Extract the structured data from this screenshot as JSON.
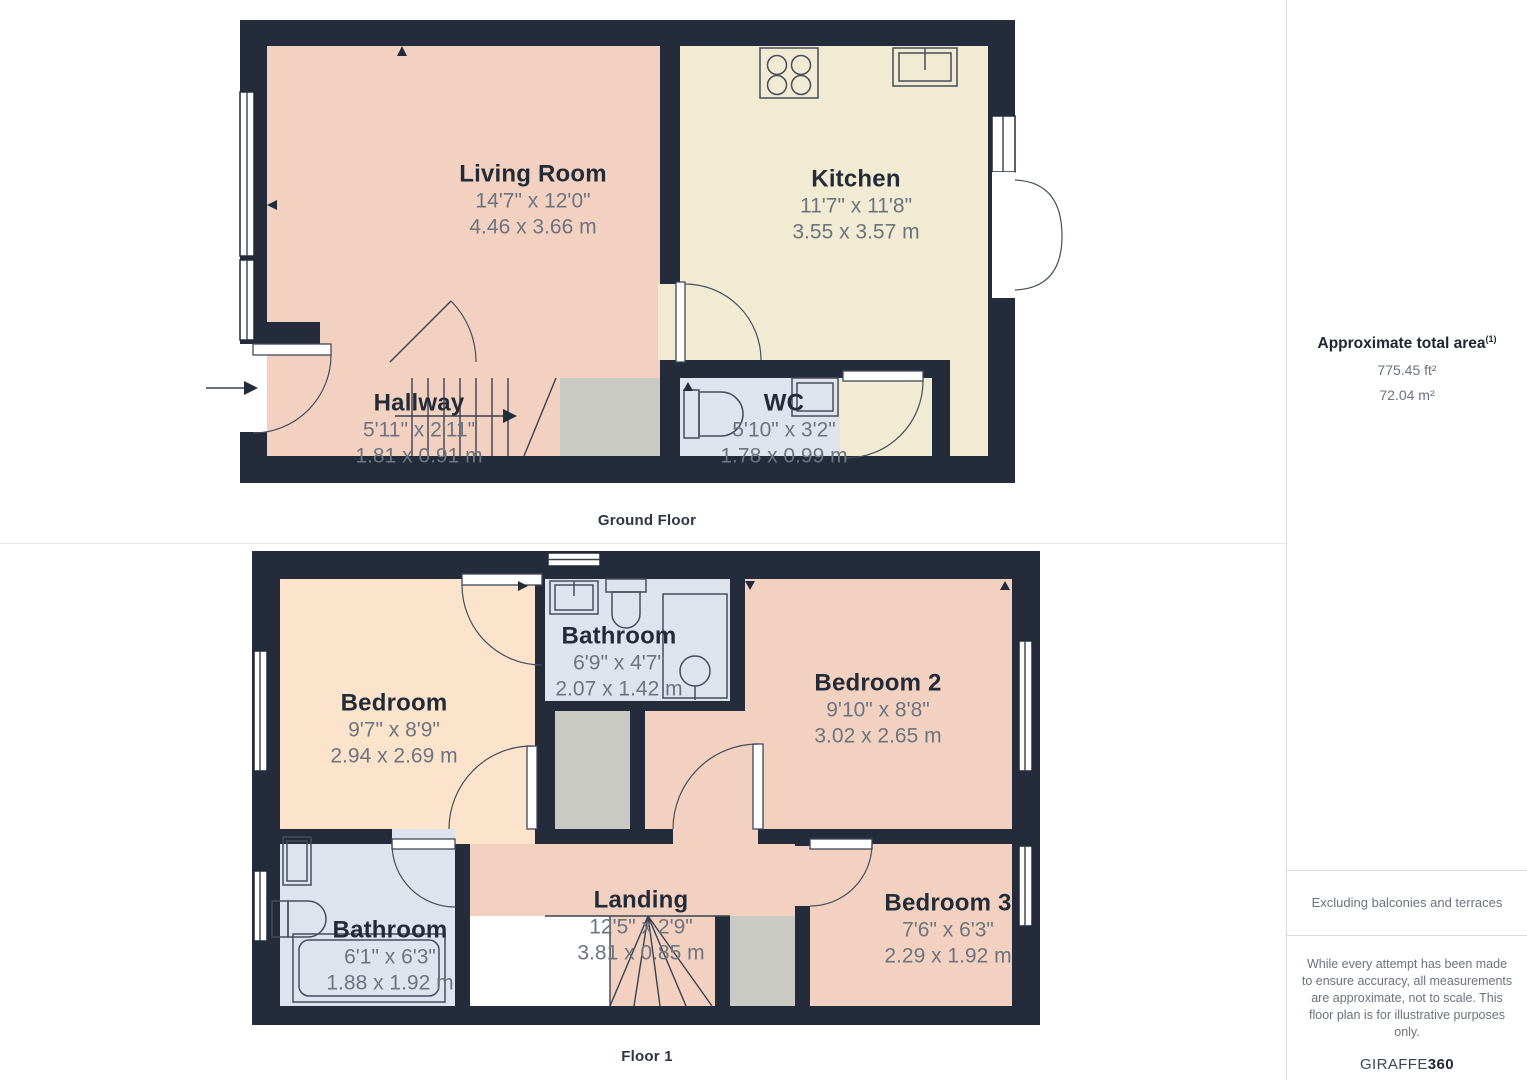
{
  "floors": [
    {
      "label": "Ground Floor",
      "rooms": [
        {
          "name": "Living Room",
          "imperial": "14'7\" x 12'0\"",
          "metric": "4.46 x 3.66 m"
        },
        {
          "name": "Kitchen",
          "imperial": "11'7\" x 11'8\"",
          "metric": "3.55 x 3.57 m"
        },
        {
          "name": "Hallway",
          "imperial": "5'11\" x 2'11\"",
          "metric": "1.81 x 0.91 m"
        },
        {
          "name": "WC",
          "imperial": "5'10\" x 3'2\"",
          "metric": "1.78 x 0.99 m"
        }
      ]
    },
    {
      "label": "Floor 1",
      "rooms": [
        {
          "name": "Bedroom",
          "imperial": "9'7\" x 8'9\"",
          "metric": "2.94 x 2.69 m"
        },
        {
          "name": "Bathroom",
          "imperial": "6'9\" x 4'7\"",
          "metric": "2.07 x 1.42 m"
        },
        {
          "name": "Bedroom 2",
          "imperial": "9'10\" x 8'8\"",
          "metric": "3.02 x 2.65 m"
        },
        {
          "name": "Bathroom",
          "imperial": "6'1\" x 6'3\"",
          "metric": "1.88 x 1.92 m"
        },
        {
          "name": "Landing",
          "imperial": "12'5\" x 2'9\"",
          "metric": "3.81 x 0.85 m"
        },
        {
          "name": "Bedroom 3",
          "imperial": "7'6\" x 6'3\"",
          "metric": "2.29 x 1.92 m"
        }
      ]
    }
  ],
  "sidebar": {
    "total_area_title": "Approximate total area",
    "total_area_superscript": "(1)",
    "area_ft": "775.45 ft²",
    "area_m": "72.04 m²",
    "exclusion_note": "Excluding balconies and terraces",
    "disclaimer": "While every attempt has been made to ensure accuracy, all measurements are approximate, not to scale. This floor plan is for illustrative purposes only.",
    "brand_name": "GIRAFFE",
    "brand_number": "360"
  },
  "colors": {
    "wall": "#242b3a",
    "room_pink": "#f2d1c0",
    "room_cream": "#f1ebd3",
    "room_peach": "#fce4cc",
    "room_blue": "#dee3ee",
    "room_gray": "#c9cac3",
    "accent_text": "#232b39",
    "dim_text": "#6d7480"
  }
}
